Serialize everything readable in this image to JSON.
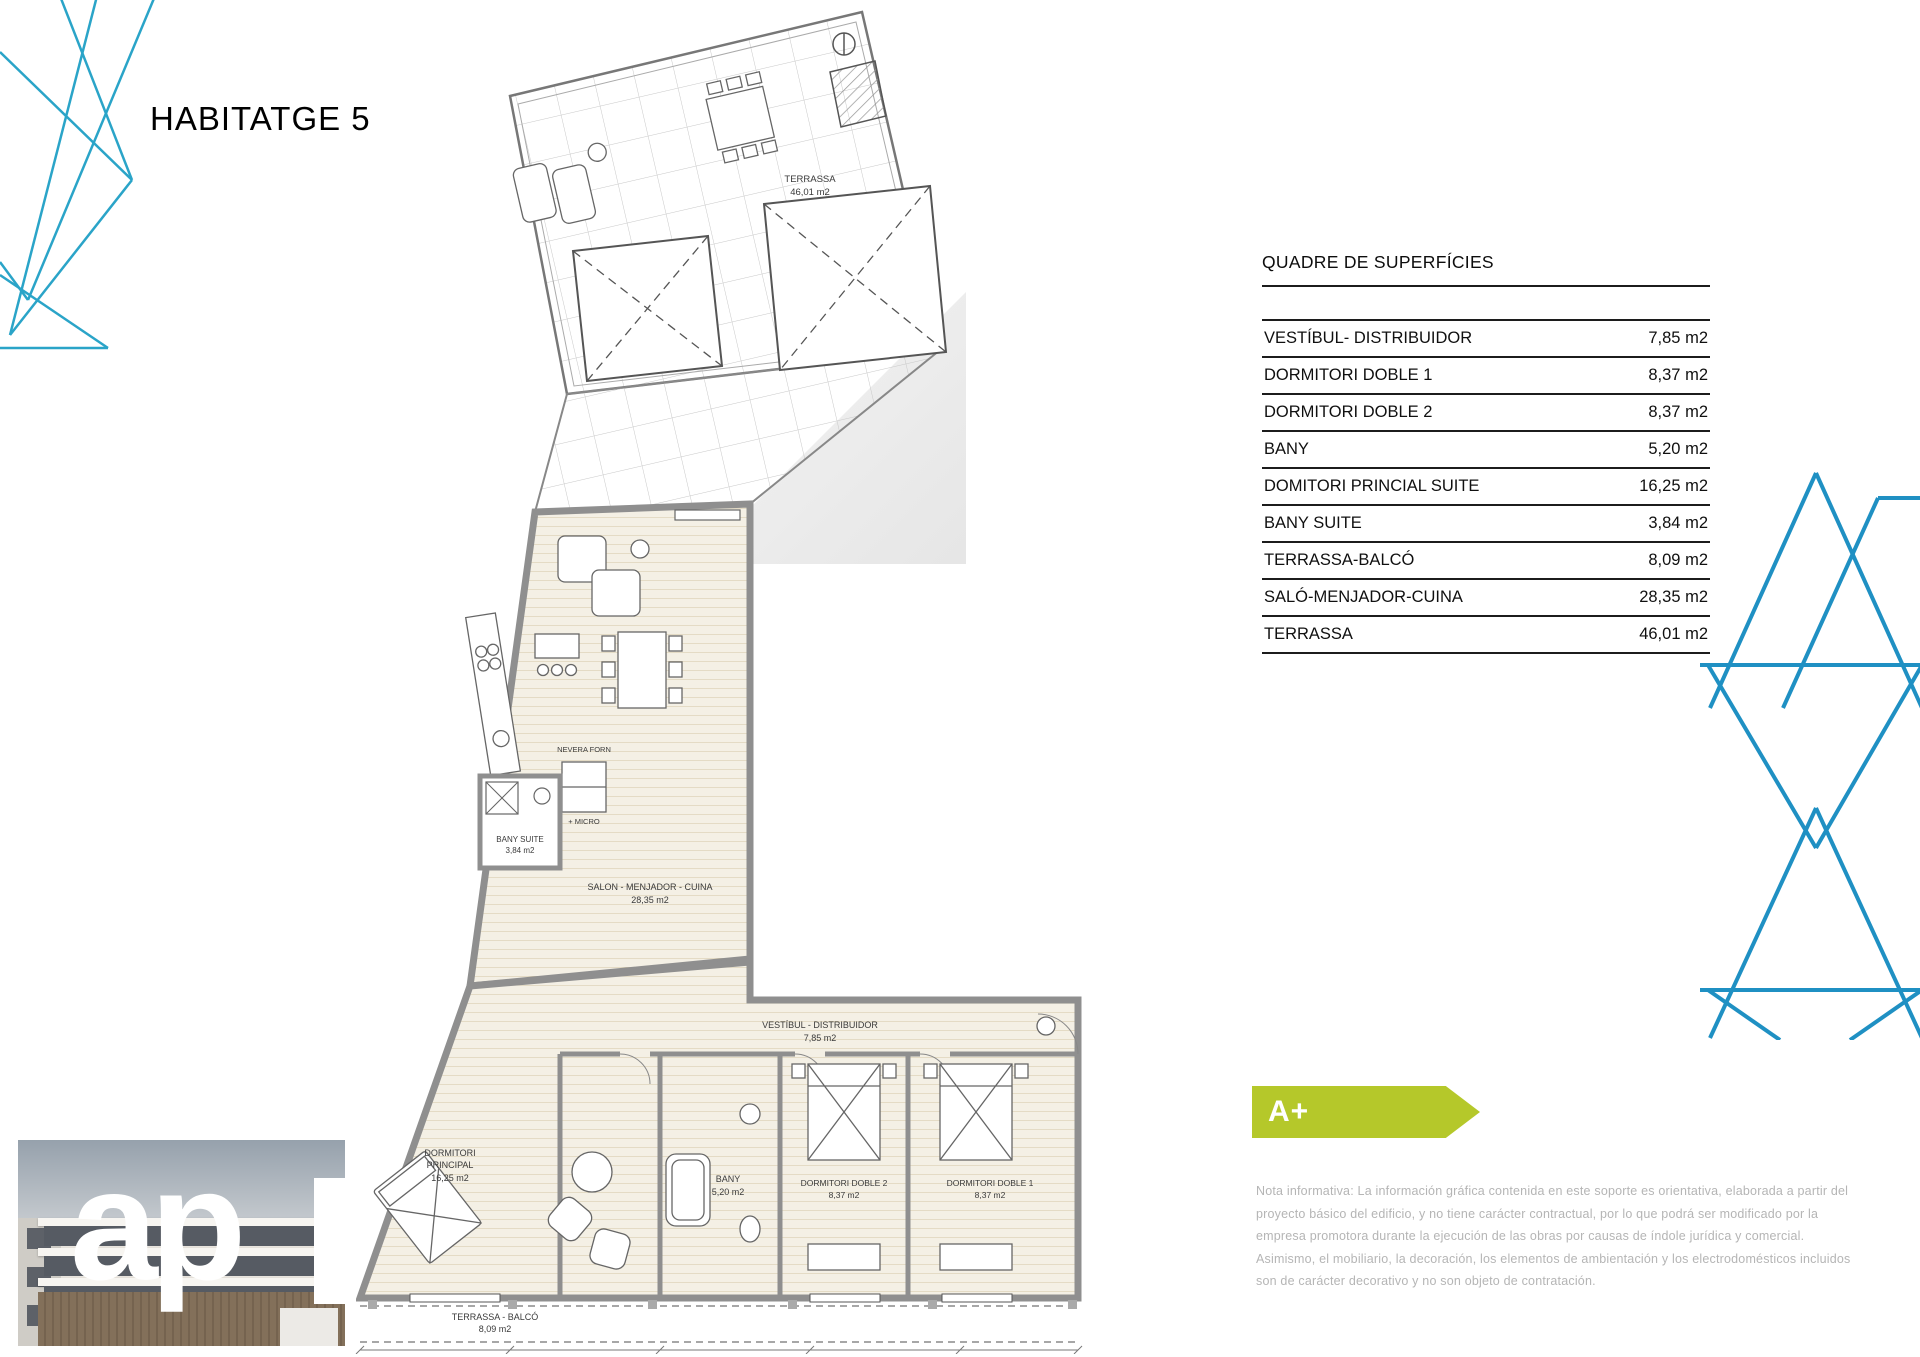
{
  "header": {
    "title": "HABITATGE 5"
  },
  "surfaces": {
    "title": "QUADRE DE SUPERFÍCIES",
    "rows": [
      {
        "label": "VESTÍBUL- DISTRIBUIDOR",
        "value": "7,85 m2"
      },
      {
        "label": "DORMITORI DOBLE 1",
        "value": "8,37 m2"
      },
      {
        "label": "DORMITORI DOBLE 2",
        "value": "8,37 m2"
      },
      {
        "label": "BANY",
        "value": "5,20 m2"
      },
      {
        "label": "DOMITORI PRINCIAL SUITE",
        "value": "16,25 m2"
      },
      {
        "label": "BANY SUITE",
        "value": "3,84 m2"
      },
      {
        "label": "TERRASSA-BALCÓ",
        "value": "8,09 m2"
      },
      {
        "label": "SALÓ-MENJADOR-CUINA",
        "value": "28,35 m2"
      },
      {
        "label": "TERRASSA",
        "value": "46,01 m2"
      }
    ]
  },
  "floorplan": {
    "terrassa": {
      "name": "TERRASSA",
      "area": "46,01 m2"
    },
    "salo": {
      "name": "SALON - MENJADOR - CUINA",
      "area": "28,35 m2"
    },
    "nevera": {
      "line1": "NEVERA FORN",
      "line2": "+ MICRO"
    },
    "bany_suite": {
      "name": "BANY SUITE",
      "area": "3,84 m2"
    },
    "vestibul": {
      "name": "VESTÍBUL - DISTRIBUIDOR",
      "area": "7,85 m2"
    },
    "principal": {
      "line1": "DORMITORI",
      "line2": "PRINCIPAL",
      "area": "16,25 m2"
    },
    "bany": {
      "name": "BANY",
      "area": "5,20 m2"
    },
    "doble2": {
      "name": "DORMITORI DOBLE 2",
      "area": "8,37 m2"
    },
    "doble1": {
      "name": "DORMITORI DOBLE 1",
      "area": "8,37 m2"
    },
    "balco": {
      "name": "TERRASSA - BALCÓ",
      "area": "8,09 m2"
    }
  },
  "energy": {
    "grade": "A+",
    "color": "#b5c82a"
  },
  "legal_note": {
    "text": "Nota informativa: La información gráfica contenida en este soporte es orientativa, elaborada a partir del proyecto básico del edificio, y no tiene carácter contractual, por lo que podrá ser modificado por la empresa promotora durante la ejecución de las obras por causas de índole jurídica y comercial. Asimismo, el mobiliario, la decoración, los elementos de ambientación y los electrodomésticos incluidos son de carácter decorativo y no son objeto de contratación."
  },
  "logo": {
    "text": "ap"
  },
  "colors": {
    "accent_blue": "#2196c4",
    "energy_green": "#b5c82a"
  }
}
